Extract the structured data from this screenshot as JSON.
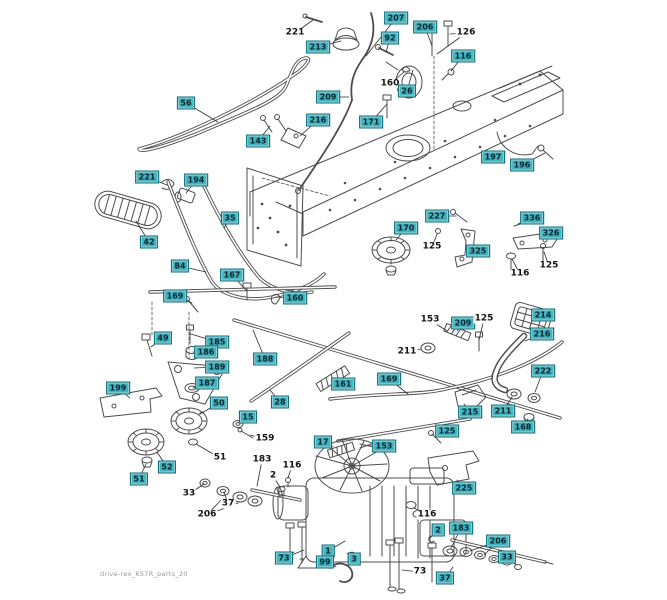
{
  "page": {
    "watermark": "drive-rex_K57R_parts_20"
  },
  "colors": {
    "background": "#ffffff",
    "callout_bg": "#46b2be",
    "callout_border": "#0d6d7a",
    "callout_text": "#06262d",
    "leader_line": "#2e2e2e",
    "line_art": "#4c4c4c"
  },
  "labels": [
    {
      "text": "221",
      "boxed": false,
      "x": 295,
      "y": 33,
      "tx": 313,
      "ty": 20
    },
    {
      "text": "213",
      "boxed": true,
      "x": 318,
      "y": 47,
      "tx": 341,
      "ty": 41
    },
    {
      "text": "207",
      "boxed": true,
      "x": 396,
      "y": 18,
      "tx": 366,
      "ty": 56
    },
    {
      "text": "206",
      "boxed": true,
      "x": 425,
      "y": 27,
      "tx": 432,
      "ty": 46
    },
    {
      "text": "126",
      "boxed": false,
      "x": 466,
      "y": 33,
      "tx": 450,
      "ty": 34,
      "tx2": 437,
      "ty2": 54
    },
    {
      "text": "92",
      "boxed": true,
      "x": 390,
      "y": 38,
      "tx": 386,
      "ty": 52
    },
    {
      "text": "116",
      "boxed": true,
      "x": 463,
      "y": 56,
      "tx": 451,
      "ty": 71
    },
    {
      "text": "56",
      "boxed": true,
      "x": 186,
      "y": 103,
      "tx": 218,
      "ty": 122
    },
    {
      "text": "160",
      "boxed": false,
      "x": 390,
      "y": 84,
      "tx": 404,
      "ty": 72
    },
    {
      "text": "26",
      "boxed": true,
      "x": 407,
      "y": 91,
      "tx": 413,
      "ty": 70
    },
    {
      "text": "209",
      "boxed": true,
      "x": 328,
      "y": 97,
      "tx": 349,
      "ty": 97
    },
    {
      "text": "216",
      "boxed": true,
      "x": 318,
      "y": 120,
      "tx": 300,
      "ty": 136
    },
    {
      "text": "171",
      "boxed": true,
      "x": 371,
      "y": 122,
      "tx": 387,
      "ty": 104
    },
    {
      "text": "143",
      "boxed": true,
      "x": 258,
      "y": 141,
      "tx": 270,
      "ty": 126
    },
    {
      "text": "197",
      "boxed": true,
      "x": 493,
      "y": 157,
      "tx": 505,
      "ty": 152
    },
    {
      "text": "196",
      "boxed": true,
      "x": 522,
      "y": 165,
      "tx": 545,
      "ty": 153
    },
    {
      "text": "221",
      "boxed": true,
      "x": 147,
      "y": 177,
      "tx": 167,
      "ty": 185
    },
    {
      "text": "194",
      "boxed": true,
      "x": 196,
      "y": 180,
      "tx": 186,
      "ty": 193
    },
    {
      "text": "42",
      "boxed": true,
      "x": 149,
      "y": 242,
      "tx": 136,
      "ty": 221
    },
    {
      "text": "35",
      "boxed": true,
      "x": 230,
      "y": 218,
      "tx": 224,
      "ty": 228
    },
    {
      "text": "84",
      "boxed": true,
      "x": 180,
      "y": 266,
      "tx": 206,
      "ty": 272
    },
    {
      "text": "167",
      "boxed": true,
      "x": 232,
      "y": 275,
      "tx": 247,
      "ty": 291
    },
    {
      "text": "169",
      "boxed": true,
      "x": 175,
      "y": 296,
      "tx": 192,
      "ty": 303
    },
    {
      "text": "160",
      "boxed": true,
      "x": 295,
      "y": 298,
      "tx": 276,
      "ty": 297
    },
    {
      "text": "49",
      "boxed": true,
      "x": 163,
      "y": 338,
      "tx": 151,
      "ty": 347
    },
    {
      "text": "185",
      "boxed": true,
      "x": 217,
      "y": 342,
      "tx": 191,
      "ty": 334
    },
    {
      "text": "186",
      "boxed": true,
      "x": 206,
      "y": 352,
      "tx": 193,
      "ty": 352
    },
    {
      "text": "189",
      "boxed": true,
      "x": 217,
      "y": 367,
      "tx": 194,
      "ty": 368
    },
    {
      "text": "187",
      "boxed": true,
      "x": 207,
      "y": 383,
      "tx": 193,
      "ty": 388
    },
    {
      "text": "188",
      "boxed": true,
      "x": 265,
      "y": 359,
      "tx": 253,
      "ty": 330
    },
    {
      "text": "199",
      "boxed": true,
      "x": 118,
      "y": 388,
      "tx": 130,
      "ty": 398
    },
    {
      "text": "50",
      "boxed": true,
      "x": 219,
      "y": 403,
      "tx": 200,
      "ty": 414
    },
    {
      "text": "28",
      "boxed": true,
      "x": 280,
      "y": 402,
      "tx": 270,
      "ty": 390
    },
    {
      "text": "161",
      "boxed": true,
      "x": 343,
      "y": 384,
      "tx": 334,
      "ty": 379
    },
    {
      "text": "169",
      "boxed": true,
      "x": 389,
      "y": 379,
      "tx": 408,
      "ty": 394
    },
    {
      "text": "15",
      "boxed": true,
      "x": 248,
      "y": 417,
      "tx": 240,
      "ty": 422
    },
    {
      "text": "159",
      "boxed": false,
      "x": 265,
      "y": 439,
      "tx": 250,
      "ty": 435
    },
    {
      "text": "51",
      "boxed": false,
      "x": 220,
      "y": 458,
      "tx": 196,
      "ty": 444
    },
    {
      "text": "52",
      "boxed": true,
      "x": 167,
      "y": 467,
      "tx": 157,
      "ty": 452
    },
    {
      "text": "51",
      "boxed": true,
      "x": 139,
      "y": 479,
      "tx": 146,
      "ty": 464
    },
    {
      "text": "33",
      "boxed": false,
      "x": 189,
      "y": 494,
      "tx": 204,
      "ty": 484
    },
    {
      "text": "37",
      "boxed": false,
      "x": 228,
      "y": 504,
      "tx": 224,
      "ty": 492
    },
    {
      "text": "206",
      "boxed": false,
      "x": 207,
      "y": 515,
      "tx": 221,
      "ty": 500,
      "tx2": 238,
      "ty2": 503
    },
    {
      "text": "183",
      "boxed": false,
      "x": 262,
      "y": 460,
      "tx": 257,
      "ty": 486
    },
    {
      "text": "116",
      "boxed": false,
      "x": 292,
      "y": 466,
      "tx": 288,
      "ty": 478
    },
    {
      "text": "2",
      "boxed": false,
      "x": 273,
      "y": 476,
      "tx": 280,
      "ty": 487
    },
    {
      "text": "170",
      "boxed": true,
      "x": 406,
      "y": 228,
      "tx": 396,
      "ty": 240
    },
    {
      "text": "227",
      "boxed": true,
      "x": 437,
      "y": 216,
      "tx": 456,
      "ty": 216
    },
    {
      "text": "125",
      "boxed": false,
      "x": 432,
      "y": 247,
      "tx": 437,
      "ty": 234
    },
    {
      "text": "325",
      "boxed": true,
      "x": 478,
      "y": 251,
      "tx": 471,
      "ty": 252
    },
    {
      "text": "336",
      "boxed": true,
      "x": 532,
      "y": 218,
      "tx": 518,
      "ty": 224
    },
    {
      "text": "326",
      "boxed": true,
      "x": 551,
      "y": 233,
      "tx": 544,
      "ty": 237
    },
    {
      "text": "116",
      "boxed": false,
      "x": 520,
      "y": 274,
      "tx": 512,
      "ty": 259
    },
    {
      "text": "125",
      "boxed": false,
      "x": 549,
      "y": 266,
      "tx": 544,
      "ty": 252
    },
    {
      "text": "153",
      "boxed": false,
      "x": 430,
      "y": 320,
      "tx": 447,
      "ty": 331
    },
    {
      "text": "209",
      "boxed": true,
      "x": 463,
      "y": 323,
      "tx": 457,
      "ty": 331
    },
    {
      "text": "125",
      "boxed": false,
      "x": 484,
      "y": 319,
      "tx": 479,
      "ty": 340
    },
    {
      "text": "214",
      "boxed": true,
      "x": 543,
      "y": 315,
      "tx": 532,
      "ty": 318
    },
    {
      "text": "216",
      "boxed": true,
      "x": 542,
      "y": 334,
      "tx": 525,
      "ty": 341
    },
    {
      "text": "211",
      "boxed": false,
      "x": 407,
      "y": 352,
      "tx": 421,
      "ty": 349
    },
    {
      "text": "222",
      "boxed": true,
      "x": 543,
      "y": 371,
      "tx": 535,
      "ty": 392
    },
    {
      "text": "215",
      "boxed": true,
      "x": 470,
      "y": 412,
      "tx": 464,
      "ty": 404
    },
    {
      "text": "211",
      "boxed": true,
      "x": 503,
      "y": 411,
      "tx": 512,
      "ty": 397
    },
    {
      "text": "168",
      "boxed": true,
      "x": 523,
      "y": 427,
      "tx": 528,
      "ty": 419
    },
    {
      "text": "125",
      "boxed": true,
      "x": 447,
      "y": 431,
      "tx": 437,
      "ty": 437
    },
    {
      "text": "17",
      "boxed": true,
      "x": 323,
      "y": 442,
      "tx": 333,
      "ty": 447
    },
    {
      "text": "153",
      "boxed": true,
      "x": 384,
      "y": 446,
      "tx": 368,
      "ty": 446
    },
    {
      "text": "225",
      "boxed": true,
      "x": 464,
      "y": 488,
      "tx": 457,
      "ty": 480
    },
    {
      "text": "116",
      "boxed": false,
      "x": 427,
      "y": 515,
      "tx": 414,
      "ty": 508
    },
    {
      "text": "2",
      "boxed": true,
      "x": 438,
      "y": 530,
      "tx": 430,
      "ty": 538
    },
    {
      "text": "183",
      "boxed": true,
      "x": 461,
      "y": 528,
      "tx": 451,
      "ty": 548
    },
    {
      "text": "206",
      "boxed": true,
      "x": 498,
      "y": 541,
      "tx": 470,
      "ty": 551,
      "tx2": 484,
      "ty2": 555
    },
    {
      "text": "33",
      "boxed": true,
      "x": 507,
      "y": 557,
      "tx": 516,
      "ty": 565
    },
    {
      "text": "37",
      "boxed": true,
      "x": 445,
      "y": 578,
      "tx": 453,
      "ty": 567
    },
    {
      "text": "73",
      "boxed": false,
      "x": 420,
      "y": 572,
      "tx": 402,
      "ty": 570
    },
    {
      "text": "73",
      "boxed": true,
      "x": 284,
      "y": 558,
      "tx": 294,
      "ty": 552,
      "tx2": 304,
      "ty2": 550
    },
    {
      "text": "1",
      "boxed": true,
      "x": 328,
      "y": 551,
      "tx": 345,
      "ty": 541
    },
    {
      "text": "99",
      "boxed": true,
      "x": 325,
      "y": 562,
      "tx": 336,
      "ty": 567
    },
    {
      "text": "3",
      "boxed": true,
      "x": 354,
      "y": 559,
      "tx": 350,
      "ty": 554
    }
  ]
}
